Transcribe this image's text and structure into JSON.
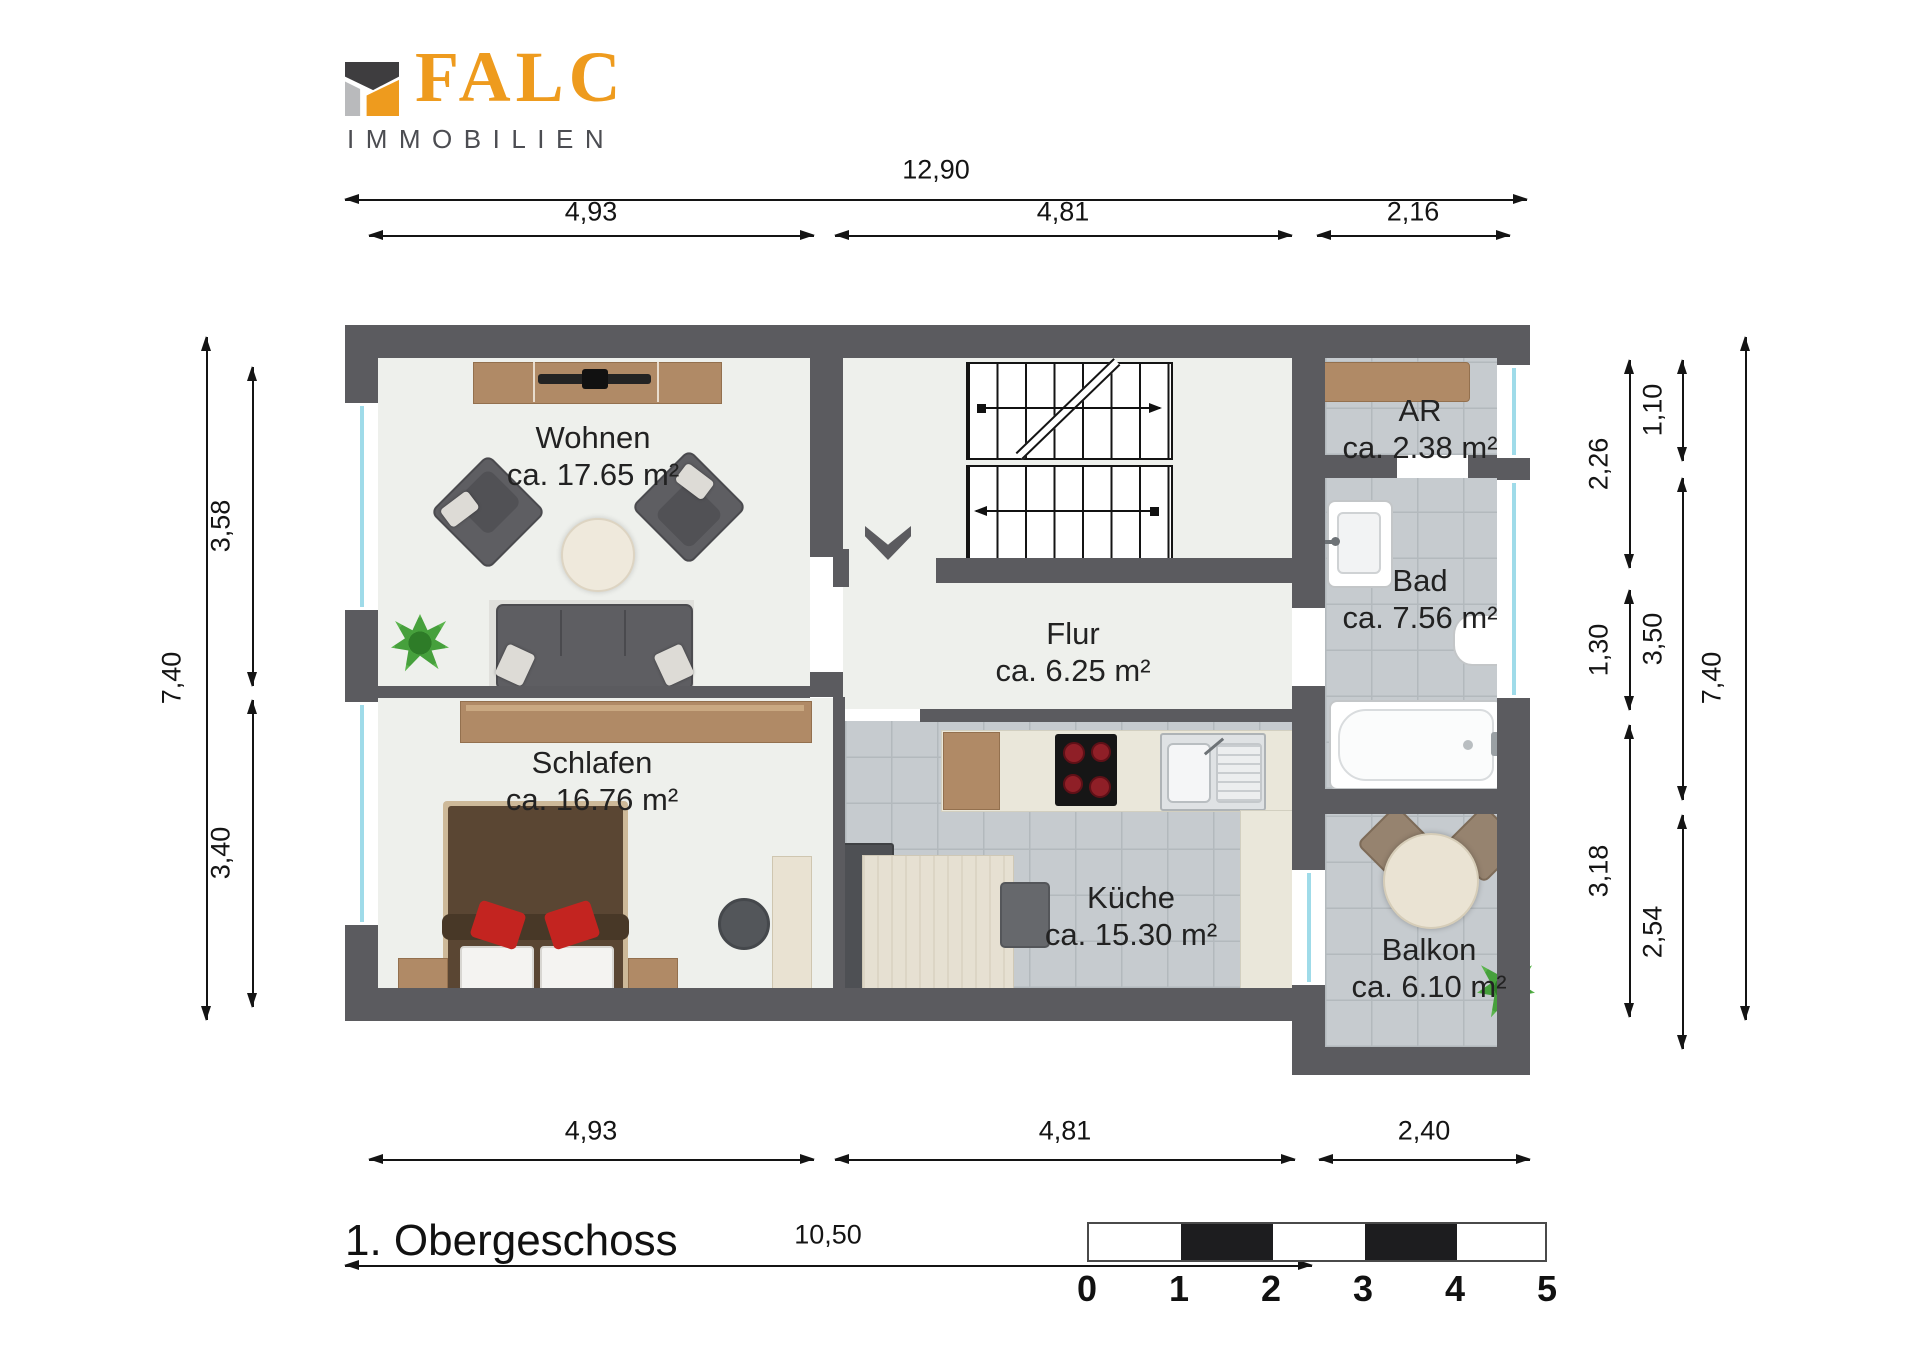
{
  "brand": {
    "name": "FALC",
    "subtitle": "IMMOBILIEN"
  },
  "floor_title": "1. Obergeschoss",
  "rooms": [
    {
      "name": "Wohnen",
      "area": "ca. 17.65 m²"
    },
    {
      "name": "Schlafen",
      "area": "ca. 16.76 m²"
    },
    {
      "name": "Flur",
      "area": "ca. 6.25 m²"
    },
    {
      "name": "Küche",
      "area": "ca. 15.30 m²"
    },
    {
      "name": "AR",
      "area": "ca. 2.38 m²"
    },
    {
      "name": "Bad",
      "area": "ca. 7.56 m²"
    },
    {
      "name": "Balkon",
      "area": "ca. 6.10 m²"
    }
  ],
  "dimensions": {
    "top_total": "12,90",
    "top_segments": [
      "4,93",
      "4,81",
      "2,16"
    ],
    "bottom_segments": [
      "4,93",
      "4,81",
      "2,40"
    ],
    "bottom_total": "10,50",
    "left_total": "7,40",
    "left_segments": [
      "3,58",
      "3,40"
    ],
    "right_inner": [
      "2,26",
      "1,30",
      "3,18"
    ],
    "right_middle": [
      "1,10",
      "3,50",
      "2,54"
    ],
    "right_total": "7,40"
  },
  "scale_bar": {
    "ticks": [
      "0",
      "1",
      "2",
      "3",
      "4",
      "5"
    ]
  },
  "colors": {
    "wall": "#5b5b5f",
    "accent_orange": "#ee9b1e",
    "floor": "#eef0ec",
    "tile": "#c6cbcf",
    "glazing": "#9fdbe9"
  }
}
